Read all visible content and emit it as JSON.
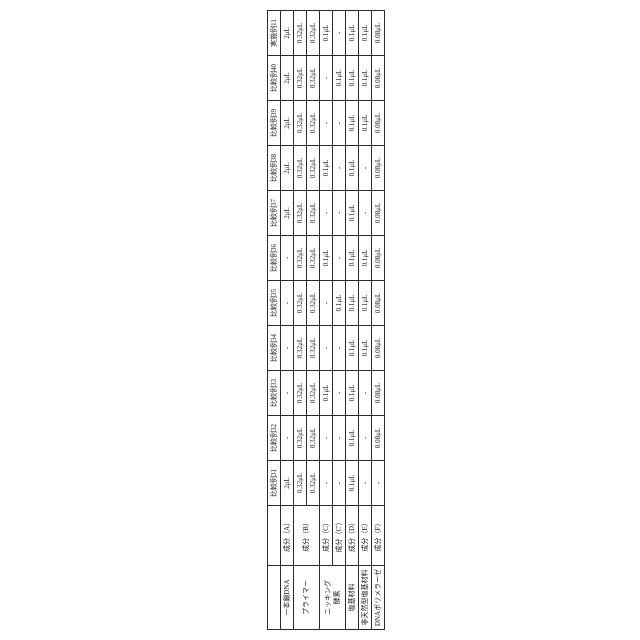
{
  "page": {
    "background_color": "#ffffff",
    "line_color": "#2a2a2a"
  },
  "table": {
    "corner_headers": [
      "",
      ""
    ],
    "col_headers": [
      "比較例31",
      "比較例32",
      "比較例33",
      "比較例34",
      "比較例35",
      "比較例36",
      "比較例37",
      "比較例38",
      "比較例39",
      "比較例40",
      "実施例11"
    ],
    "rows": [
      {
        "category": "一本鎖DNA",
        "category_span": 1,
        "component": "成分（A）",
        "component_span": 1,
        "values": [
          "2μL",
          "-",
          "-",
          "-",
          "-",
          "-",
          "2μL",
          "2μL",
          "2μL",
          "2μL",
          "2μL"
        ]
      },
      {
        "category": "プライマー",
        "category_span": 2,
        "component": "成分（B）",
        "component_span": 2,
        "values": [
          "0.32μL",
          "0.32μL",
          "0.32μL",
          "0.32μL",
          "0.32μL",
          "0.32μL",
          "0.32μL",
          "0.32μL",
          "0.32μL",
          "0.32μL",
          "0.32μL"
        ]
      },
      {
        "values": [
          "0.32μL",
          "0.32μL",
          "0.32μL",
          "0.32μL",
          "0.32μL",
          "0.32μL",
          "0.32μL",
          "0.32μL",
          "0.32μL",
          "0.32μL",
          "0.32μL"
        ]
      },
      {
        "category": "ニッキング\n酵素",
        "category_span": 2,
        "component": "成分（C）",
        "component_span": 1,
        "values": [
          "-",
          "-",
          "0.1μL",
          "-",
          "-",
          "0.1μL",
          "-",
          "0.1μL",
          "-",
          "-",
          "0.1μL"
        ]
      },
      {
        "component": "成分（C'）",
        "component_span": 1,
        "values": [
          "-",
          "-",
          "-",
          "-",
          "0.1μL",
          "-",
          "-",
          "-",
          "-",
          "0.1μL",
          "-"
        ]
      },
      {
        "category": "塩基材料",
        "category_span": 1,
        "component": "成分（D）",
        "component_span": 1,
        "values": [
          "0.1μL",
          "0.1μL",
          "0.1μL",
          "0.1μL",
          "0.1μL",
          "0.1μL",
          "0.1μL",
          "0.1μL",
          "0.1μL",
          "0.1μL",
          "0.1μL"
        ]
      },
      {
        "category": "非天然型塩基材料",
        "category_span": 1,
        "component": "成分（E）",
        "component_span": 1,
        "values": [
          "-",
          "-",
          "-",
          "0.1μL",
          "0.1μL",
          "0.1μL",
          "-",
          "-",
          "0.1μL",
          "0.1μL",
          "0.1μL"
        ]
      },
      {
        "category": "DNAポリメラーゼ",
        "category_span": 1,
        "component": "成分（F）",
        "component_span": 1,
        "values": [
          "-",
          "0.08μL",
          "0.08μL",
          "0.08μL",
          "0.08μL",
          "0.08μL",
          "0.08μL",
          "0.08μL",
          "0.08μL",
          "0.08μL",
          "0.08μL"
        ]
      }
    ]
  }
}
